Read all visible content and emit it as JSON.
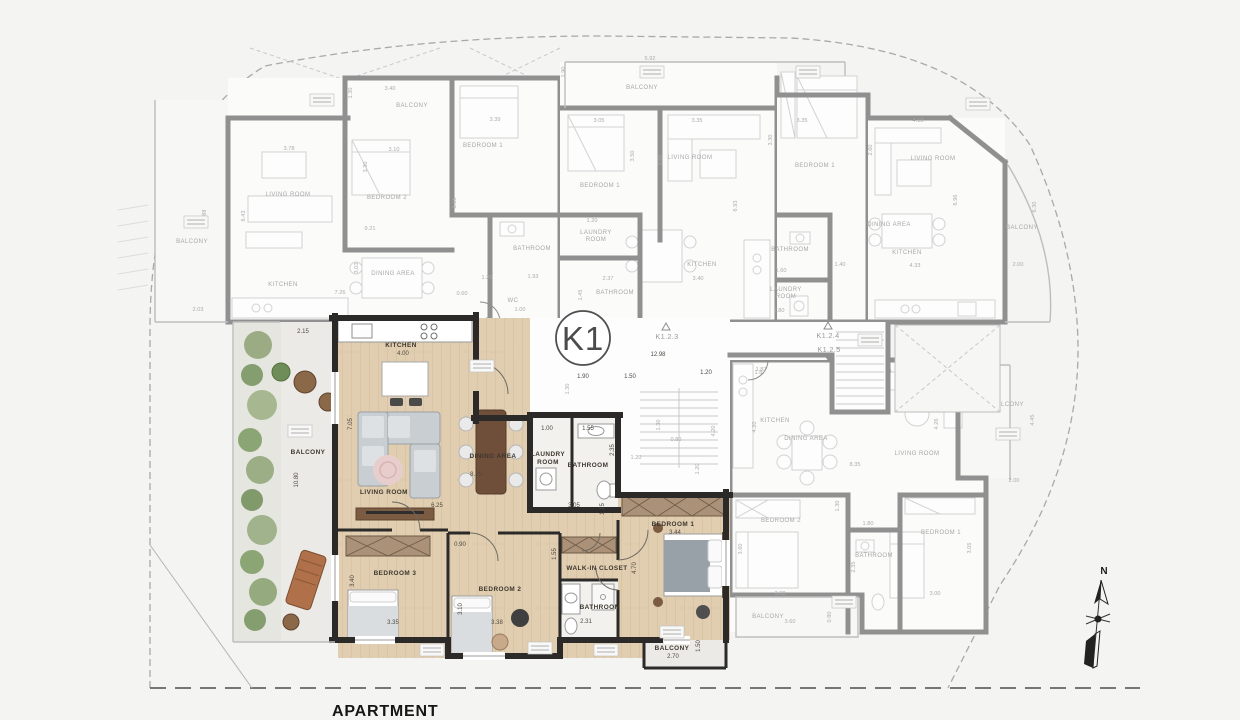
{
  "page": {
    "footer_label": "APARTMENT"
  },
  "compass": {
    "label": "N"
  },
  "core": {
    "badge": "K1",
    "stairs": {
      "up_left": "K1.2.2",
      "entry": "K1.2.1",
      "mid": "K1.2.3",
      "up_right": "K1.2.4",
      "down_right": "K1.2.5"
    },
    "dims": {
      "corridor": "12.98",
      "w1": "1.90",
      "w2": "1.50",
      "w3": "1.20",
      "w4": "1.87",
      "s1": "1.30",
      "s2": "0.80",
      "s3": "1.20",
      "s4": "4.20",
      "s5": "1.20",
      "s6": "1.30"
    }
  },
  "unit_k1": {
    "kitchen": {
      "name": "KITCHEN",
      "w": "4.00"
    },
    "living": {
      "name": "LIVING ROOM",
      "w": "8.25",
      "w2": "6.25",
      "h": "7.05"
    },
    "dining": {
      "name": "DINING AREA"
    },
    "laundry": {
      "lines": [
        "LAUNDRY",
        "ROOM"
      ],
      "w": "1.00"
    },
    "bath_top": {
      "name": "BATHROOM",
      "w": "1.55",
      "h": "2.35"
    },
    "hall": {
      "w": "3.05",
      "h": "1.15",
      "w2": "0.90"
    },
    "bed1": {
      "name": "BEDROOM 1",
      "w": "3.44",
      "h": "4.70"
    },
    "closet": {
      "name": "WALK-IN CLOSET",
      "h": "1.55"
    },
    "bath_bottom": {
      "name": "BATHROOM",
      "w": "2.31"
    },
    "bed2": {
      "name": "BEDROOM 2",
      "w": "3.38",
      "h": "3.10"
    },
    "bed3": {
      "name": "BEDROOM 3",
      "w": "3.35",
      "h": "3.40"
    },
    "balcony_left": {
      "name": "BALCONY",
      "h": "10.80",
      "w": "2.15"
    },
    "balcony_bottom": {
      "name": "BALCONY",
      "w": "2.70",
      "h": "1.50"
    }
  },
  "unit_nw": {
    "balcony": {
      "name": "BALCONY",
      "h": "6.88",
      "w": "2.03"
    },
    "balcony_top": {
      "name": "BALCONY",
      "w": "3.40",
      "h": "1.30"
    },
    "living": {
      "name": "LIVING ROOM",
      "w": "3.78",
      "h": "6.43"
    },
    "kitchen": {
      "name": "KITCHEN",
      "w": "7.26"
    },
    "dining": {
      "name": "DINING AREA",
      "h": "3.03"
    },
    "bed2": {
      "name": "BEDROOM 2",
      "w": "3.10",
      "h": "3.30"
    },
    "bed1": {
      "name": "BEDROOM 1",
      "w": "3.39",
      "h": "3.15"
    },
    "bath": {
      "name": "BATHROOM",
      "w": "1.93"
    },
    "wc": {
      "name": "WC",
      "h": "1.00"
    },
    "hall": {
      "w": "9.21",
      "d1": "1.25",
      "d2": "0.60"
    }
  },
  "unit_n": {
    "balcony": {
      "name": "BALCONY",
      "w": "5.92",
      "h": "1.90"
    },
    "bed1": {
      "name": "BEDROOM 1",
      "w": "3.05",
      "h": "3.50"
    },
    "living": {
      "name": "LIVING ROOM",
      "w": "3.35",
      "h": "3.55"
    },
    "kitchen": {
      "name": "KITCHEN",
      "w": "3.40"
    },
    "laundry": {
      "lines": [
        "LAUNDRY",
        "ROOM"
      ],
      "w": "1.20"
    },
    "bath": {
      "name": "BATHROOM",
      "w": "2.37",
      "h": "1.45"
    },
    "hall_h": "6.93"
  },
  "unit_ne_mid": {
    "bed1": {
      "name": "BEDROOM 1",
      "w": "3.35",
      "h": "3.30"
    },
    "bath": {
      "name": "BATHROOM",
      "h": "1.60"
    },
    "laundry": {
      "lines": [
        "LAUNDRY",
        "ROOM"
      ],
      "w": "1.80"
    },
    "d1": "1.40"
  },
  "unit_ne": {
    "living": {
      "name": "LIVING ROOM",
      "w": "4.10",
      "h": "2.60"
    },
    "dining": {
      "name": "DINING AREA"
    },
    "kitchen": {
      "name": "KITCHEN",
      "w": "4.33"
    },
    "balcony": {
      "name": "BALCONY",
      "w": "2.00",
      "h": "6.30"
    },
    "side_h": "6.96"
  },
  "unit_e": {
    "kitchen": {
      "name": "KITCHEN",
      "w": "1.87",
      "h": "4.20"
    },
    "dining": {
      "name": "DINING AREA"
    },
    "living": {
      "name": "LIVING ROOM",
      "w": "8.35",
      "w2": "6.33",
      "h": "4.26"
    },
    "balcony_right": {
      "name": "BALCONY",
      "w": "2.00",
      "h": "4.45"
    },
    "bed2": {
      "name": "BEDROOM 2",
      "w": "3.30",
      "h": "3.60"
    },
    "bath": {
      "name": "BATHROOM",
      "w": "1.80",
      "h": "2.35"
    },
    "bed1": {
      "name": "BEDROOM 1",
      "w": "3.00",
      "h": "3.05"
    },
    "balcony_bottom": {
      "name": "BALCONY",
      "w": "3.60",
      "h": "0.80"
    },
    "hall_h": "1.30"
  }
}
